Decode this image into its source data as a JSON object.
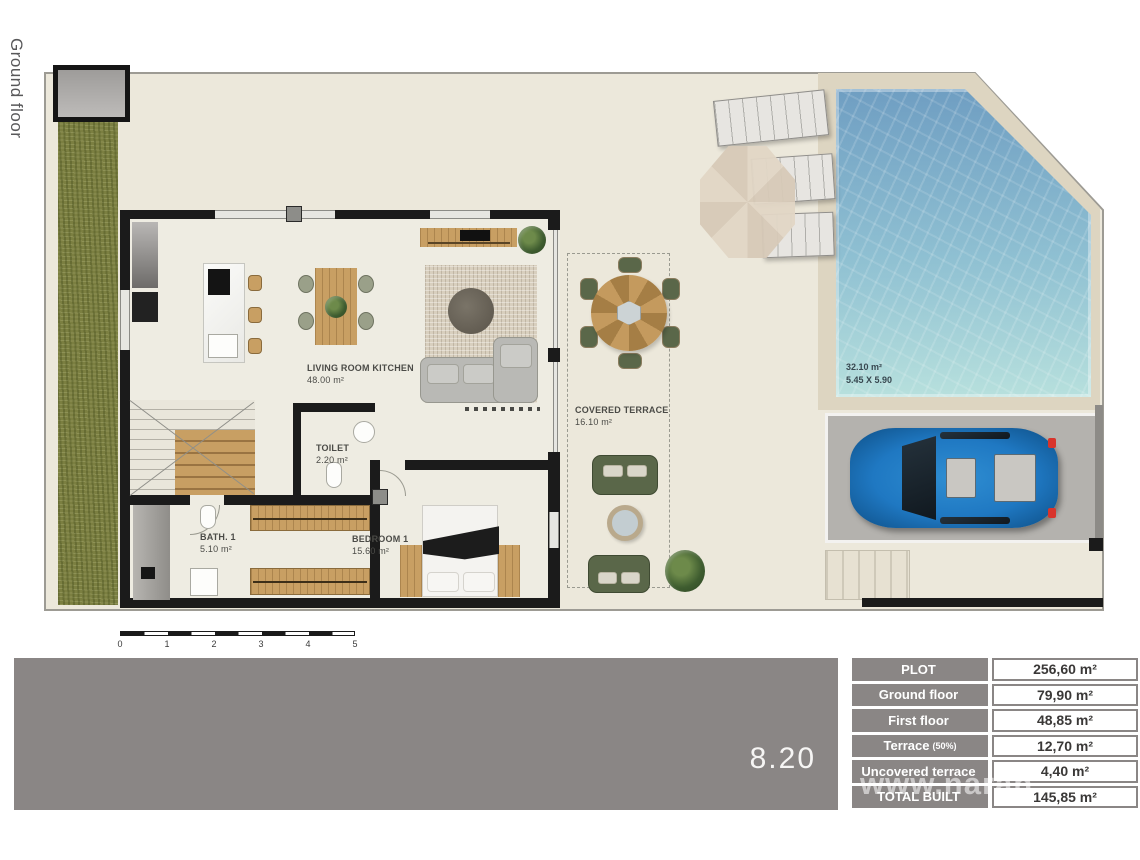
{
  "sidebar": {
    "floor_label": "Ground floor"
  },
  "plan": {
    "rooms": [
      {
        "name": "LIVING ROOM KITCHEN",
        "area": "48.00 m²"
      },
      {
        "name": "TOILET",
        "area": "2.20 m²"
      },
      {
        "name": "BATH. 1",
        "area": "5.10 m²"
      },
      {
        "name": "BEDROOM 1",
        "area": "15.60 m²"
      },
      {
        "name": "COVERED TERRACE",
        "area": "16.10 m²"
      }
    ],
    "pool": {
      "area": "32.10 m²",
      "dimensions": "5.45 X 5.90"
    },
    "scale_bar": {
      "ticks": [
        "0",
        "1",
        "2",
        "3",
        "4",
        "5"
      ]
    }
  },
  "footer": {
    "plan_number": "8.20",
    "watermark": "www.naran"
  },
  "summary_table": {
    "rows": [
      {
        "label": "PLOT",
        "value": "256,60 m²"
      },
      {
        "label": "Ground floor",
        "value": "79,90 m²"
      },
      {
        "label": "First floor",
        "value": "48,85 m²"
      },
      {
        "label": "Terrace",
        "note": "(50%)",
        "value": "12,70 m²"
      },
      {
        "label": "Uncovered terrace",
        "value": "4,40 m²"
      },
      {
        "label": "TOTAL BUILT",
        "value": "145,85 m²"
      }
    ]
  },
  "colors": {
    "bar_gray": "#8a8685",
    "grass_green": "#7b7f41",
    "pool_blue": "#7fb3cf",
    "wall_black": "#1b1b1b",
    "plot_beige": "#ece8db",
    "car_blue": "#1f78c2"
  }
}
